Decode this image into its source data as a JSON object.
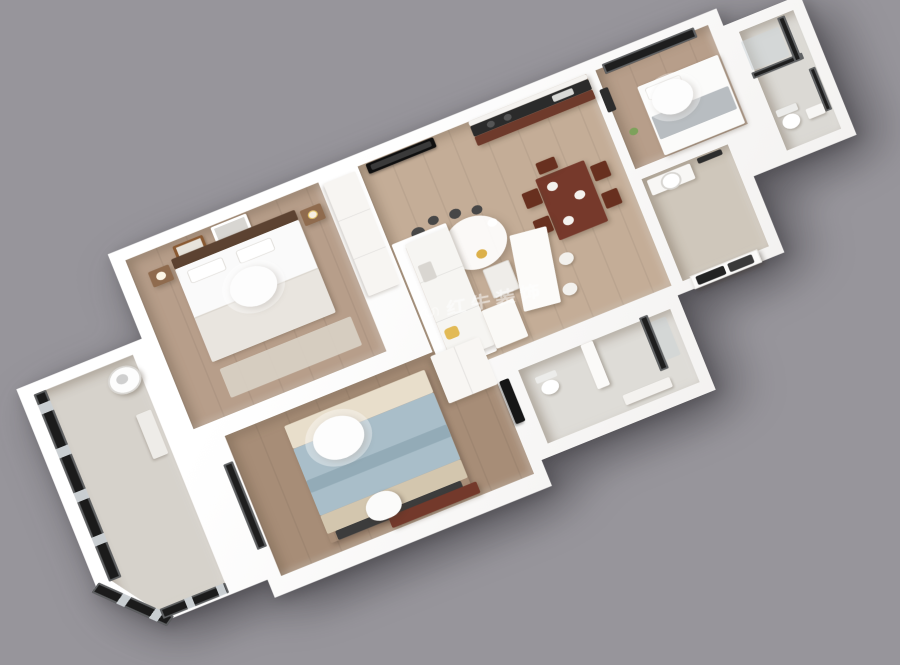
{
  "scene": {
    "view": "3d-axonometric-apartment-render",
    "description": "Photorealistic 3D bird's-eye render of a two-bedroom apartment floor plan on a plain gray background",
    "background_color": "#97959b"
  },
  "watermark": {
    "text": "红牛装饰",
    "color": "#ffffff",
    "opacity": 0.55
  },
  "palette": {
    "bg": "#97959b",
    "slab_light": "#ffffff",
    "slab_shade": "#efedeb",
    "wood_bedroom": "#b79e8a",
    "wood_living": "#c4ad97",
    "wood_bedroom2": "#a78d77",
    "tile_bath": "#dbd9d4",
    "tile_entry": "#cfc7bb",
    "marble_balcony": "#d6d2cb",
    "frame_dark": "#1e1e1e",
    "furniture_wood": "#76392b",
    "headboard_wood": "#5c4231",
    "duvet_blue": "#a9bec9",
    "duvet_fold": "#93abb7",
    "pillow_beige": "#e8decb",
    "blanket_beige": "#d3c6ae",
    "blanket_gray": "#e9e5df",
    "accent_gold": "#dcb04a",
    "watermark_white": "#ffffff"
  },
  "rooms": [
    {
      "id": "master-bedroom",
      "label": "master bedroom",
      "floor_color": "#b79e8a",
      "furniture": [
        "double-bed",
        "dark-wood-headboard",
        "two-wall-frames",
        "nightstands",
        "round-ceiling-lamp",
        "rug",
        "wardrobe"
      ]
    },
    {
      "id": "second-bedroom",
      "label": "second bedroom",
      "floor_color": "#a78d77",
      "furniture": [
        "double-bed-blue-duvet",
        "round-ceiling-lamp",
        "wardrobe",
        "wall-tv",
        "desk",
        "chair",
        "window"
      ]
    },
    {
      "id": "living-dining",
      "label": "living / dining room",
      "floor_color": "#c4ad97",
      "furniture": [
        "white-sofa",
        "chandelier",
        "wall-tv",
        "coffee-table",
        "dining-table",
        "four-chairs",
        "bar-island",
        "stools"
      ]
    },
    {
      "id": "kitchen",
      "label": "open kitchen",
      "floor_color": "#c4ad97",
      "furniture": [
        "counter-with-cooktop",
        "dark-worktop",
        "wood-cabinets"
      ]
    },
    {
      "id": "study-bedroom",
      "label": "small bedroom / study",
      "floor_color": "#b79e8a",
      "furniture": [
        "single-bed",
        "round-ceiling-lamp",
        "black-framed-window",
        "wall-art"
      ]
    },
    {
      "id": "bathroom-right",
      "label": "bathroom (top right)",
      "floor_color": "#dbd9d4",
      "furniture": [
        "black-framed-shower",
        "toilet",
        "washbasin",
        "window"
      ]
    },
    {
      "id": "bathroom-center",
      "label": "bathroom (center)",
      "floor_color": "#dedcd7",
      "furniture": [
        "partition",
        "dark-shower-door",
        "toilet",
        "vanity-counter"
      ]
    },
    {
      "id": "entry-hall",
      "label": "entry hall",
      "floor_color": "#cfc7bb",
      "furniture": [
        "vanity-with-round-sink",
        "mirror",
        "dark-entry-door"
      ]
    },
    {
      "id": "balcony",
      "label": "glazed balcony",
      "floor_color": "#d6d2cb",
      "furniture": [
        "black-framed-glazing",
        "washing-machine",
        "shelf"
      ]
    }
  ]
}
